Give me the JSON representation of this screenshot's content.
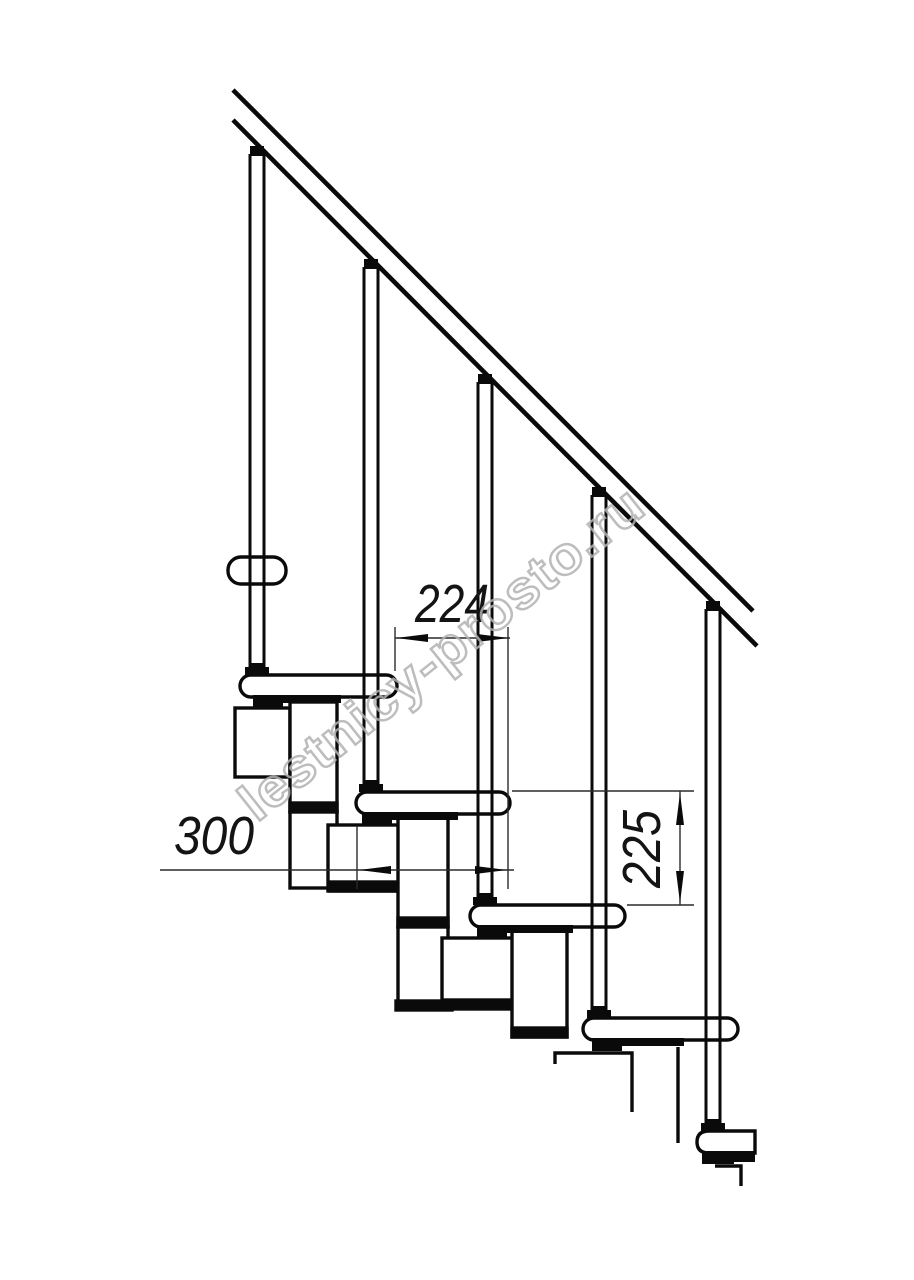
{
  "drawing": {
    "title": "modular-staircase-side-view",
    "dimensions": {
      "going": {
        "label": "224",
        "value": 224,
        "orientation": "horizontal",
        "meaning": "step-run-between-noses"
      },
      "depth": {
        "label": "300",
        "value": 300,
        "orientation": "horizontal",
        "meaning": "tread-depth"
      },
      "rise": {
        "label": "225",
        "value": 225,
        "orientation": "vertical",
        "meaning": "step-rise"
      }
    },
    "watermark": {
      "text": "lestnicy-prosto.ru",
      "color": "#b2b2b2"
    },
    "colors": {
      "line": "#0a0a0a",
      "background": "#ffffff",
      "dimension_line": "#2a2a2a"
    },
    "elements": {
      "balusters": 5,
      "treads": 5,
      "handrail": "double-line-diagonal"
    }
  }
}
